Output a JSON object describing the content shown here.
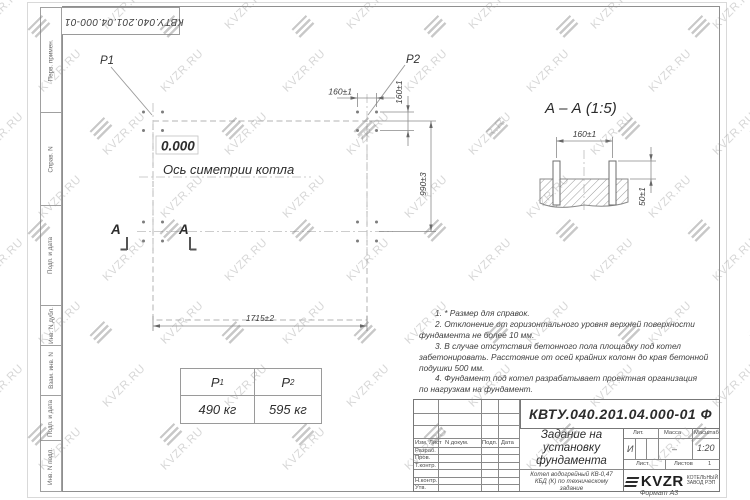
{
  "watermark": {
    "text": "KVZR.RU"
  },
  "corner_stamp": {
    "designation": "КВТУ.040.201.04.000-01 Ф"
  },
  "side_stamps": {
    "items": [
      "Перв. примен.",
      "Справ. N",
      "Подп. и дата",
      "Инв. N дубл.",
      "Взам. инв. N",
      "Подп. и дата",
      "Инв. N подл."
    ]
  },
  "plan": {
    "p1": "P1",
    "p2": "P2",
    "elevation": "0.000",
    "axis_label": "Ось симетрии котла",
    "section_letter": "А",
    "dims": {
      "bolt_spacing_x": "160±1",
      "bolt_spacing_y": "160±1",
      "row_spacing": "990±3",
      "length": "1715±2"
    }
  },
  "section_view": {
    "title": "А – А (1:5)",
    "dims": {
      "bolt_spacing": "160±1",
      "bolt_height": "50±1"
    }
  },
  "notes": {
    "lines": [
      "1. * Размер для справок.",
      "2. Отклонение от горизонтального уровня верхней поверхности",
      "фундамента не более 10 мм.",
      "3. В случае отсутствия бетонного пола площадку под котел",
      "забетонировать. Расстояние от осей крайних колонн до края бетонной",
      "подушки 500 мм.",
      "4. Фундамент под котел разрабатывает проектная организация",
      "по нагрузкам на фундамент."
    ]
  },
  "load_table": {
    "columns": [
      {
        "symbol": "P",
        "sub": "1",
        "value": "490 кг"
      },
      {
        "symbol": "P",
        "sub": "2",
        "value": "595 кг"
      }
    ]
  },
  "title_block": {
    "designation": "КВТУ.040.201.04.000-01 Ф",
    "doc_title": "Задание на установку фундамента",
    "doc_subtitle": "Котел водогрейный КВ-0,47 КБД (К) по техническому задание",
    "header_cells": [
      "Изм. Лист",
      "N докум.",
      "Подп.",
      "Дата"
    ],
    "row_labels": [
      "Разраб.",
      "Пров.",
      "Т.контр.",
      "Н.контр.",
      "Утв."
    ],
    "lit_label": "Лит.",
    "mass_label": "Масса",
    "scale_label": "Масштаб",
    "lit_value": "И",
    "mass_value": "–",
    "scale_value": "1:20",
    "sheet_label": "Лист",
    "sheets_label": "Листов",
    "sheets_value": "1",
    "logo_text": "KVZR",
    "logo_caption_1": "КОТЕЛЬНЫЙ",
    "logo_caption_2": "ЗАВОД РЭП",
    "format_label": "Формат А3"
  }
}
